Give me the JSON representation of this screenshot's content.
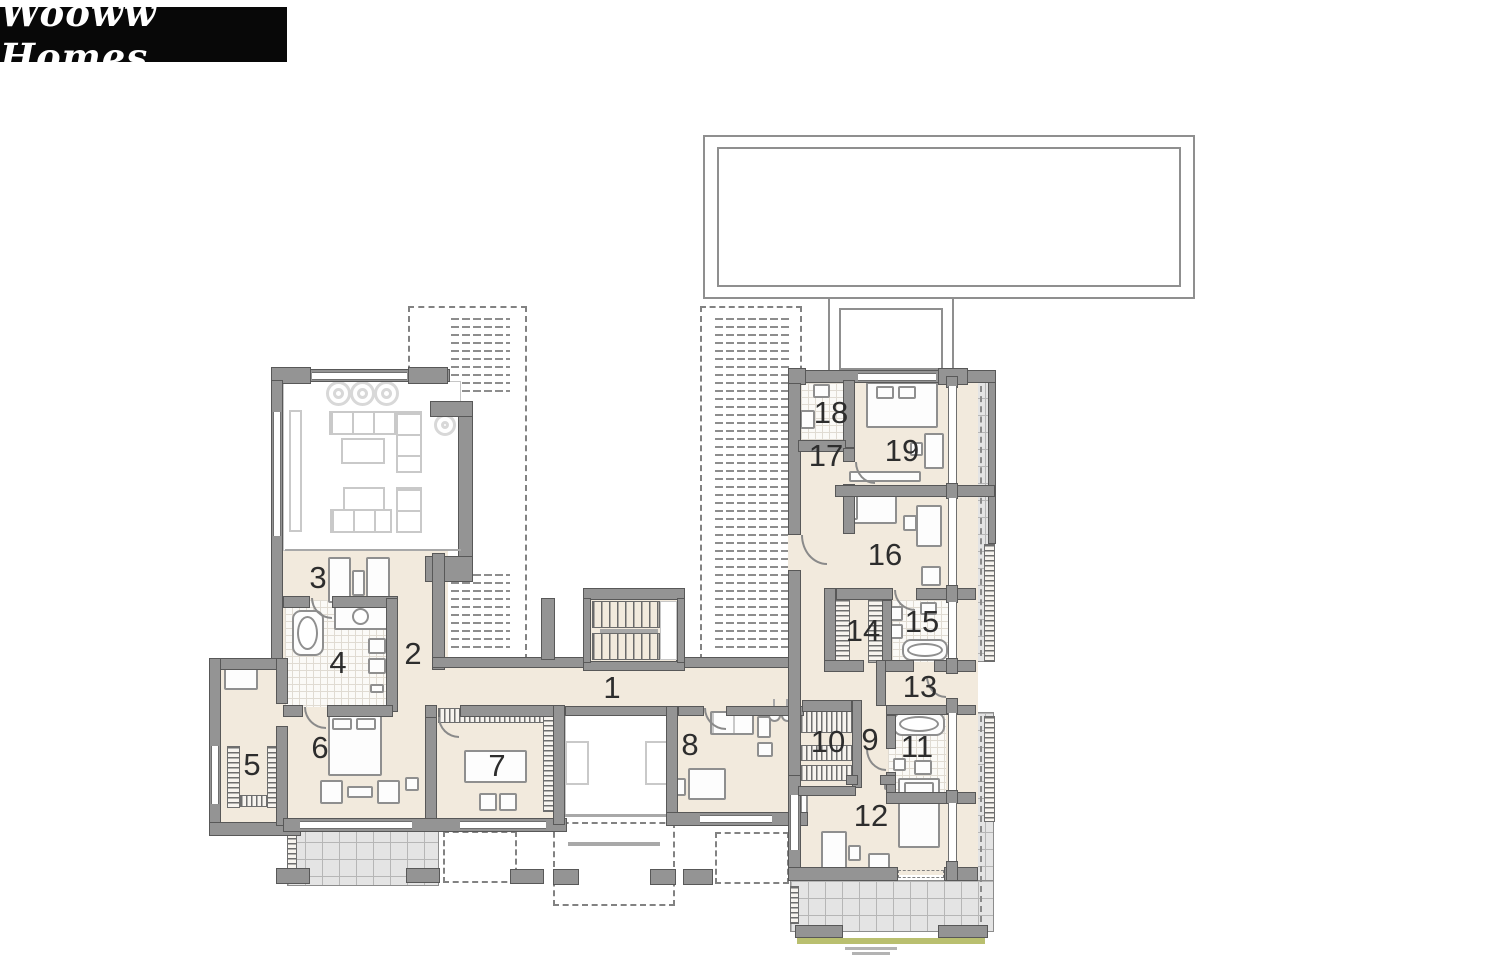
{
  "logo": {
    "text": "Wooww Homes"
  },
  "plan": {
    "rooms": [
      {
        "number": "1"
      },
      {
        "number": "2"
      },
      {
        "number": "3"
      },
      {
        "number": "4"
      },
      {
        "number": "5"
      },
      {
        "number": "6"
      },
      {
        "number": "7"
      },
      {
        "number": "8"
      },
      {
        "number": "9"
      },
      {
        "number": "10"
      },
      {
        "number": "11"
      },
      {
        "number": "12"
      },
      {
        "number": "13"
      },
      {
        "number": "14"
      },
      {
        "number": "15"
      },
      {
        "number": "16"
      },
      {
        "number": "17"
      },
      {
        "number": "18"
      },
      {
        "number": "19"
      }
    ]
  },
  "colors": {
    "floor_beige": "#f2eadd",
    "wall_gray": "#949494",
    "terrace_gray": "#e4e4e4",
    "grass_green": "#b9bf6f",
    "logo_bg": "#080808",
    "logo_text": "#ffffff"
  }
}
